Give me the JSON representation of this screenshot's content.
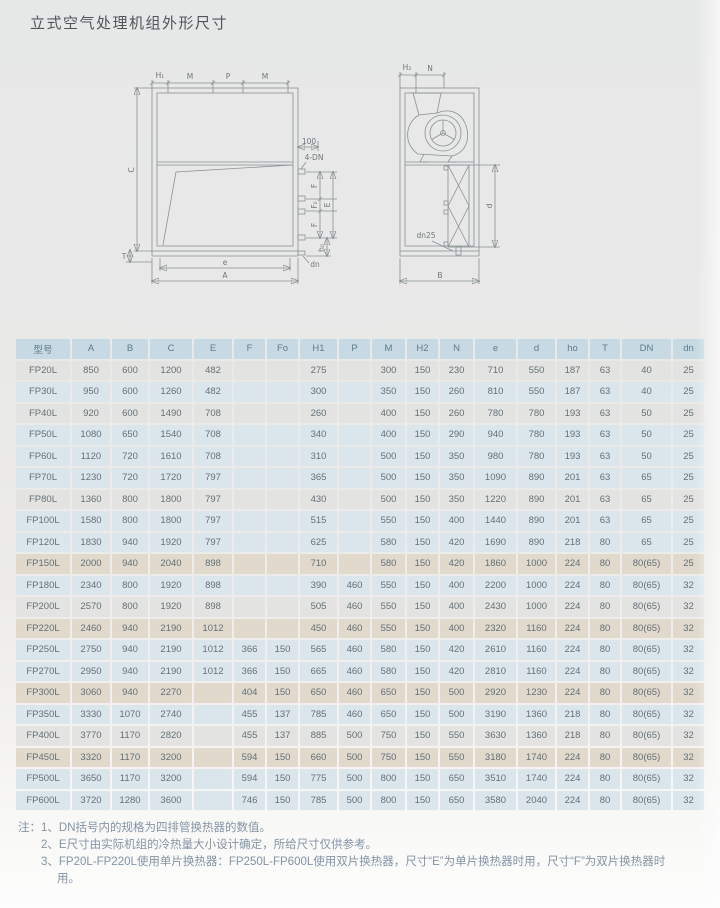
{
  "page": {
    "title": "立式空气处理机组外形尺寸"
  },
  "diagram": {
    "front": {
      "h1": "H₁",
      "m1": "M",
      "p": "P",
      "m2": "M",
      "c": "C",
      "t": "T",
      "d100": "100",
      "four_dn": "4-DN",
      "f_top": "F",
      "f0": "F₀",
      "e_vert": "E",
      "f_bot": "F",
      "ho": "h₀",
      "dn": "dn",
      "e": "e",
      "a": "A"
    },
    "side": {
      "h2": "H₂",
      "n": "N",
      "d": "d",
      "dn25": "dn25",
      "b": "B"
    }
  },
  "table": {
    "headers": [
      "型号",
      "A",
      "B",
      "C",
      "E",
      "F",
      "Fo",
      "H1",
      "P",
      "M",
      "H2",
      "N",
      "e",
      "d",
      "ho",
      "T",
      "DN",
      "dn"
    ],
    "rows": [
      {
        "tint": "gray",
        "cells": [
          "FP20L",
          "850",
          "600",
          "1200",
          "482",
          "",
          "",
          "275",
          "",
          "300",
          "150",
          "230",
          "710",
          "550",
          "187",
          "63",
          "40",
          "25"
        ]
      },
      {
        "tint": "blue",
        "cells": [
          "FP30L",
          "950",
          "600",
          "1260",
          "482",
          "",
          "",
          "300",
          "",
          "350",
          "150",
          "260",
          "810",
          "550",
          "187",
          "63",
          "40",
          "25"
        ]
      },
      {
        "tint": "gray",
        "cells": [
          "FP40L",
          "920",
          "600",
          "1490",
          "708",
          "",
          "",
          "260",
          "",
          "400",
          "150",
          "260",
          "780",
          "780",
          "193",
          "63",
          "50",
          "25"
        ]
      },
      {
        "tint": "blue",
        "cells": [
          "FP50L",
          "1080",
          "650",
          "1540",
          "708",
          "",
          "",
          "340",
          "",
          "400",
          "150",
          "290",
          "940",
          "780",
          "193",
          "63",
          "50",
          "25"
        ]
      },
      {
        "tint": "blue",
        "cells": [
          "FP60L",
          "1120",
          "720",
          "1610",
          "708",
          "",
          "",
          "310",
          "",
          "500",
          "150",
          "350",
          "980",
          "780",
          "193",
          "63",
          "50",
          "25"
        ]
      },
      {
        "tint": "blue",
        "cells": [
          "FP70L",
          "1230",
          "720",
          "1720",
          "797",
          "",
          "",
          "365",
          "",
          "500",
          "150",
          "350",
          "1090",
          "890",
          "201",
          "63",
          "65",
          "25"
        ]
      },
      {
        "tint": "gray",
        "cells": [
          "FP80L",
          "1360",
          "800",
          "1800",
          "797",
          "",
          "",
          "430",
          "",
          "500",
          "150",
          "350",
          "1220",
          "890",
          "201",
          "63",
          "65",
          "25"
        ]
      },
      {
        "tint": "blue",
        "cells": [
          "FP100L",
          "1580",
          "800",
          "1800",
          "797",
          "",
          "",
          "515",
          "",
          "550",
          "150",
          "400",
          "1440",
          "890",
          "201",
          "63",
          "65",
          "25"
        ]
      },
      {
        "tint": "blue",
        "cells": [
          "FP120L",
          "1830",
          "940",
          "1920",
          "797",
          "",
          "",
          "625",
          "",
          "580",
          "150",
          "420",
          "1690",
          "890",
          "218",
          "80",
          "65",
          "25"
        ]
      },
      {
        "tint": "beige",
        "cells": [
          "FP150L",
          "2000",
          "940",
          "2040",
          "898",
          "",
          "",
          "710",
          "",
          "580",
          "150",
          "420",
          "1860",
          "1000",
          "224",
          "80",
          "80(65)",
          "25"
        ]
      },
      {
        "tint": "blue",
        "cells": [
          "FP180L",
          "2340",
          "800",
          "1920",
          "898",
          "",
          "",
          "390",
          "460",
          "550",
          "150",
          "400",
          "2200",
          "1000",
          "224",
          "80",
          "80(65)",
          "32"
        ]
      },
      {
        "tint": "gray",
        "cells": [
          "FP200L",
          "2570",
          "800",
          "1920",
          "898",
          "",
          "",
          "505",
          "460",
          "550",
          "150",
          "400",
          "2430",
          "1000",
          "224",
          "80",
          "80(65)",
          "32"
        ]
      },
      {
        "tint": "beige",
        "cells": [
          "FP220L",
          "2460",
          "940",
          "2190",
          "1012",
          "",
          "",
          "450",
          "460",
          "550",
          "150",
          "400",
          "2320",
          "1160",
          "224",
          "80",
          "80(65)",
          "32"
        ]
      },
      {
        "tint": "blue",
        "cells": [
          "FP250L",
          "2750",
          "940",
          "2190",
          "1012",
          "366",
          "150",
          "565",
          "460",
          "580",
          "150",
          "420",
          "2610",
          "1160",
          "224",
          "80",
          "80(65)",
          "32"
        ]
      },
      {
        "tint": "blue",
        "cells": [
          "FP270L",
          "2950",
          "940",
          "2190",
          "1012",
          "366",
          "150",
          "665",
          "460",
          "580",
          "150",
          "420",
          "2810",
          "1160",
          "224",
          "80",
          "80(65)",
          "32"
        ]
      },
      {
        "tint": "beige",
        "cells": [
          "FP300L",
          "3060",
          "940",
          "2270",
          "",
          "404",
          "150",
          "650",
          "460",
          "650",
          "150",
          "500",
          "2920",
          "1230",
          "224",
          "80",
          "80(65)",
          "32"
        ]
      },
      {
        "tint": "blue",
        "cells": [
          "FP350L",
          "3330",
          "1070",
          "2740",
          "",
          "455",
          "137",
          "785",
          "460",
          "650",
          "150",
          "500",
          "3190",
          "1360",
          "218",
          "80",
          "80(65)",
          "32"
        ]
      },
      {
        "tint": "gray",
        "cells": [
          "FP400L",
          "3770",
          "1170",
          "2820",
          "",
          "455",
          "137",
          "885",
          "500",
          "750",
          "150",
          "550",
          "3630",
          "1360",
          "218",
          "80",
          "80(65)",
          "32"
        ]
      },
      {
        "tint": "beige",
        "cells": [
          "FP450L",
          "3320",
          "1170",
          "3200",
          "",
          "594",
          "150",
          "660",
          "500",
          "750",
          "150",
          "550",
          "3180",
          "1740",
          "224",
          "80",
          "80(65)",
          "32"
        ]
      },
      {
        "tint": "blue",
        "cells": [
          "FP500L",
          "3650",
          "1170",
          "3200",
          "",
          "594",
          "150",
          "775",
          "500",
          "800",
          "150",
          "650",
          "3510",
          "1740",
          "224",
          "80",
          "80(65)",
          "32"
        ]
      },
      {
        "tint": "blue",
        "cells": [
          "FP600L",
          "3720",
          "1280",
          "3600",
          "",
          "746",
          "150",
          "785",
          "500",
          "800",
          "150",
          "650",
          "3580",
          "2040",
          "224",
          "80",
          "80(65)",
          "32"
        ]
      }
    ]
  },
  "notes": {
    "prefix": "注：",
    "items": [
      "1、DN括号内的规格为四排管换热器的数值。",
      "2、E尺寸由实际机组的冷热量大小设计确定，所给尺寸仅供参考。",
      "3、FP20L-FP220L使用单片换热器：FP250L-FP600L使用双片换热器，尺寸“E”为单片换热器时用，尺寸“F”为双片换热器时用。"
    ]
  },
  "colors": {
    "header_bg": "#c7d9e3",
    "header_text": "#5e7c8c",
    "cell_text": "#646f76",
    "row_tints": {
      "blue": "#dbe6ec",
      "gray": "#e3e4e1",
      "beige": "#e0d9cc"
    },
    "line": "#8a9094",
    "note_text": "#8494a4"
  }
}
